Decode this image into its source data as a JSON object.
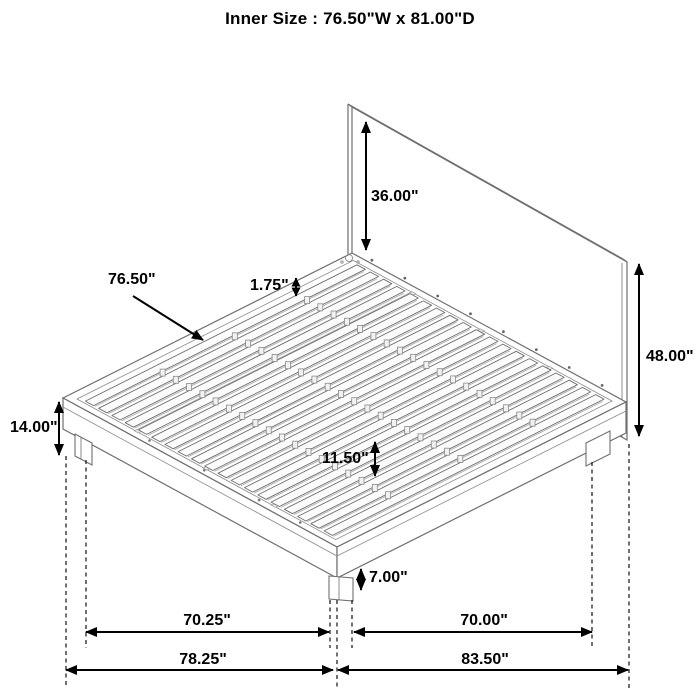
{
  "title": "Inner Size : 76.50\"W x 81.00\"D",
  "dimensions": {
    "headboard_above_platform": "36.00\"",
    "headboard_total_height": "48.00\"",
    "slat_width": "76.50\"",
    "slat_thickness": "1.75\"",
    "platform_top_height": "14.00\"",
    "under_bed_clearance": "11.50\"",
    "leg_height": "7.00\"",
    "left_leg_span": "70.25\"",
    "left_overall_span": "78.25\"",
    "right_leg_span": "70.00\"",
    "right_overall_span": "83.50\""
  },
  "colors": {
    "background": "#ffffff",
    "drawing_line": "#6f6f6f",
    "dimension_line": "#000000"
  }
}
